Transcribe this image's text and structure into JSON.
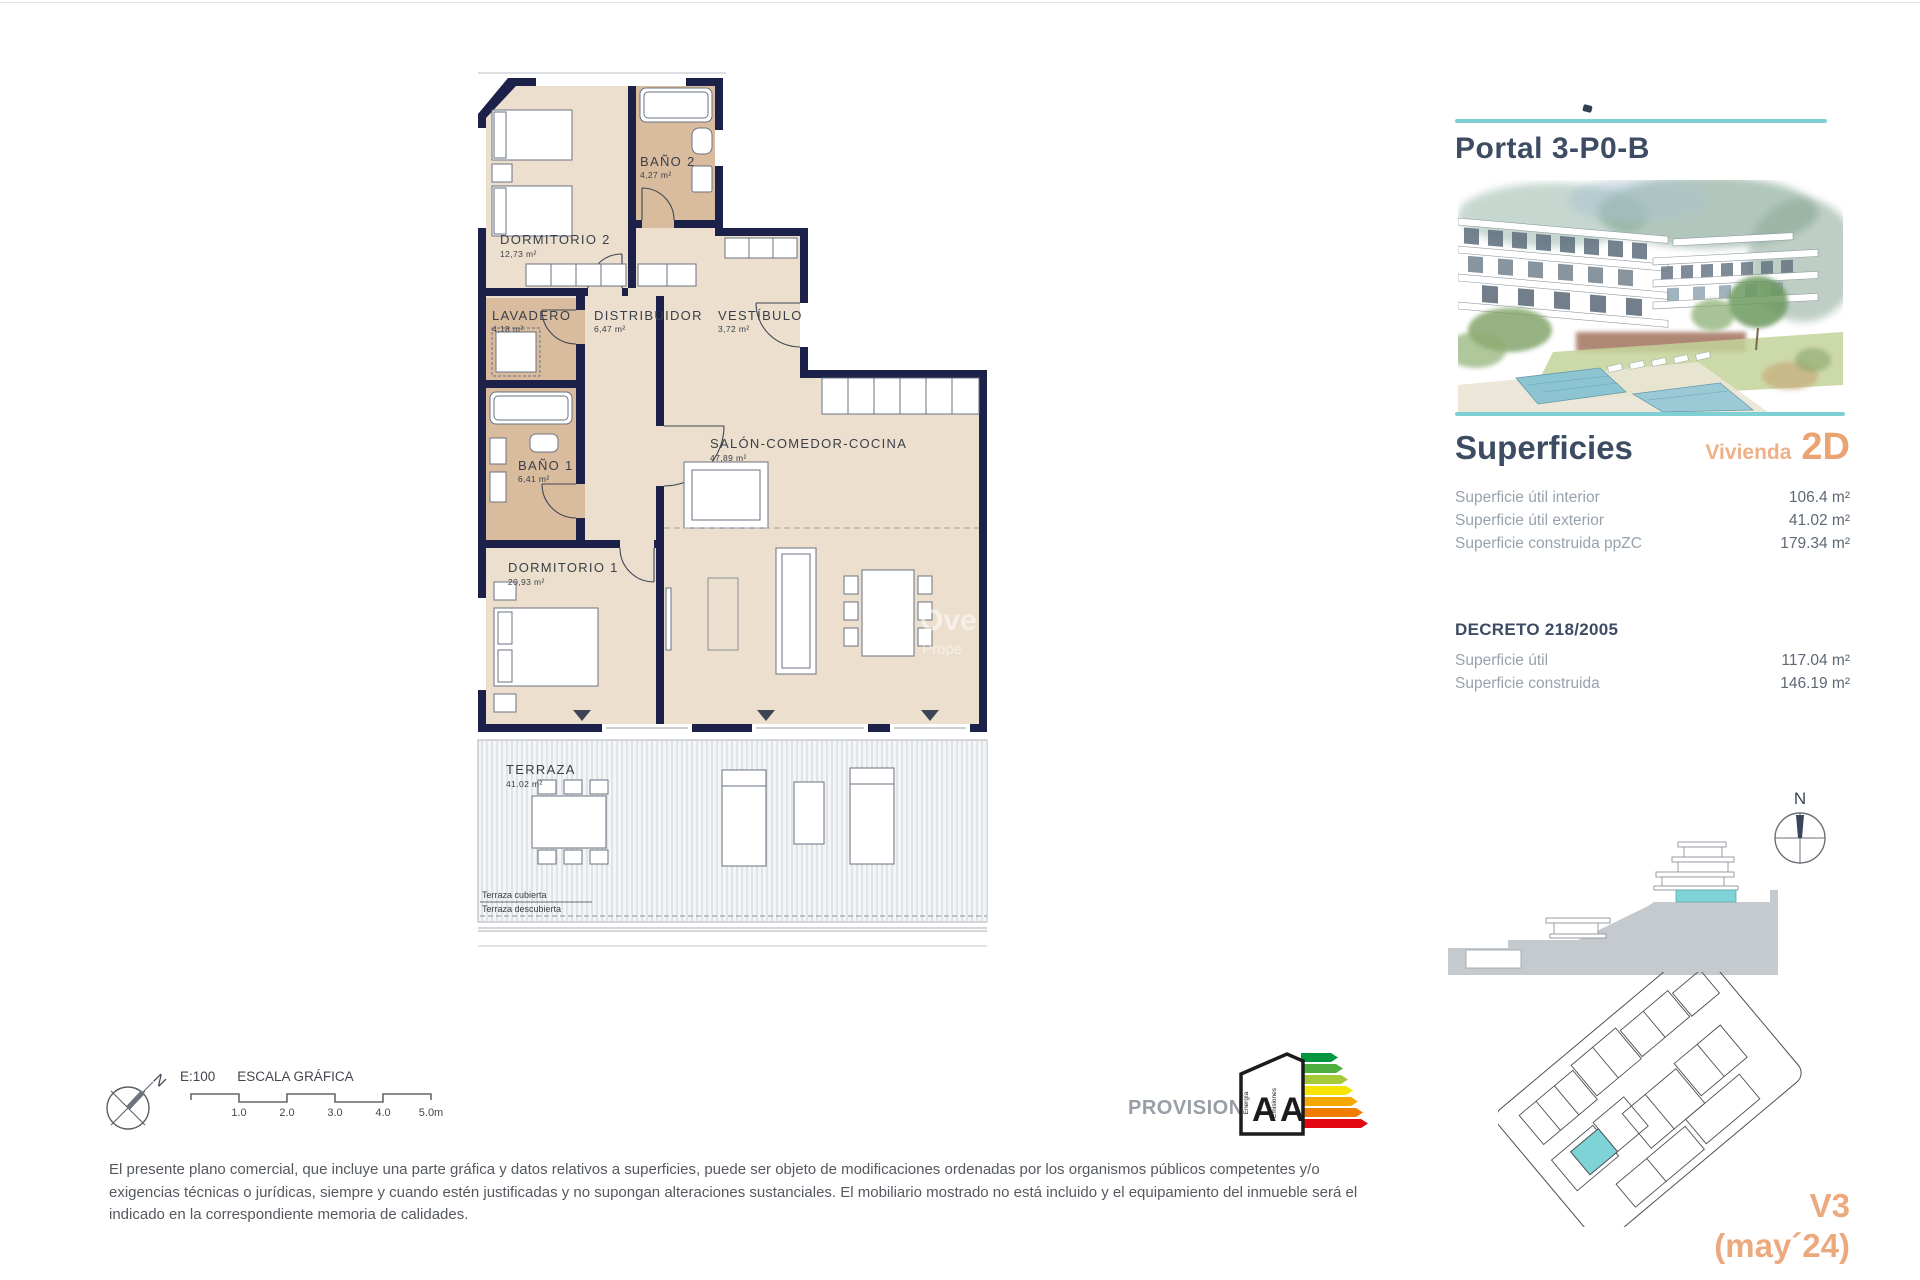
{
  "page": {
    "top_border": "#e3e4e6"
  },
  "floor_plan": {
    "rooms": [
      {
        "name": "DORMITORIO 2",
        "area": "12,73 m²"
      },
      {
        "name": "BAÑO 2",
        "area": "4,27 m²"
      },
      {
        "name": "LAVADERO",
        "area": "4,18 m²"
      },
      {
        "name": "DISTRIBUIDOR",
        "area": "6,47 m²"
      },
      {
        "name": "VESTÍBULO",
        "area": "3,72 m²"
      },
      {
        "name": "BAÑO 1",
        "area": "6,41 m²"
      },
      {
        "name": "DORMITORIO 1",
        "area": "20,93 m²"
      },
      {
        "name": "SALÓN-COMEDOR-COCINA",
        "area": "47,89 m²"
      },
      {
        "name": "TERRAZA",
        "area": "41.02 m²"
      }
    ],
    "terrace_covered_label": "Terraza cubierta",
    "terrace_uncovered_label": "Terraza descubierta",
    "watermark_line1": "Ove",
    "watermark_line2": "Prope"
  },
  "sidebar": {
    "title": "Portal 3-P0-B",
    "superficies_heading": "Superficies",
    "vivienda_label": "Vivienda",
    "vivienda_type": "2D",
    "superficies_rows": [
      {
        "label": "Superficie útil interior",
        "value": "106.4 m²"
      },
      {
        "label": "Superficie útil exterior",
        "value": "41.02 m²"
      },
      {
        "label": "Superficie construida ppZC",
        "value": "179.34 m²"
      }
    ],
    "decreto_heading": "DECRETO 218/2005",
    "decreto_rows": [
      {
        "label": "Superficie útil",
        "value": "117.04 m²"
      },
      {
        "label": "Superficie construida",
        "value": "146.19 m²"
      }
    ],
    "section_north_label": "N",
    "version": "V3",
    "version_date": "(may´24)"
  },
  "footer": {
    "scale_label": "E:100",
    "scale_title": "ESCALA GRÁFICA",
    "scale_ticks": [
      "1.0",
      "2.0",
      "3.0",
      "4.0",
      "5.0m"
    ],
    "north_label": "N",
    "provisional_label": "PROVISIONAL",
    "energy": {
      "letters": [
        "A",
        "A"
      ],
      "axis": [
        "Energía",
        "Emisiones"
      ]
    },
    "disclaimer": "El presente plano comercial, que incluye una parte gráfica y datos relativos a superficies, puede ser objeto de modificaciones ordenadas por los organismos públicos competentes y/o exigencias técnicas o jurídicas, siempre y cuando estén justificadas y no supongan alteraciones sustanciales. El mobiliario mostrado no está incluido y el equipamiento del inmueble será el indicado en la correspondiente memoria de calidades."
  },
  "colors": {
    "wall_navy": "#1b2148",
    "room_beige": "#ecdfce",
    "room_tan": "#d9bb9e",
    "accent_teal": "#7fd0d4",
    "accent_orange": "#e9a471",
    "heading_navy": "#3d4c63",
    "section_highlight": "#7ed3d6",
    "energy_scale": [
      "#00963f",
      "#4caf3e",
      "#a6c939",
      "#f7e500",
      "#f5a800",
      "#ef7d00",
      "#e30613"
    ]
  }
}
